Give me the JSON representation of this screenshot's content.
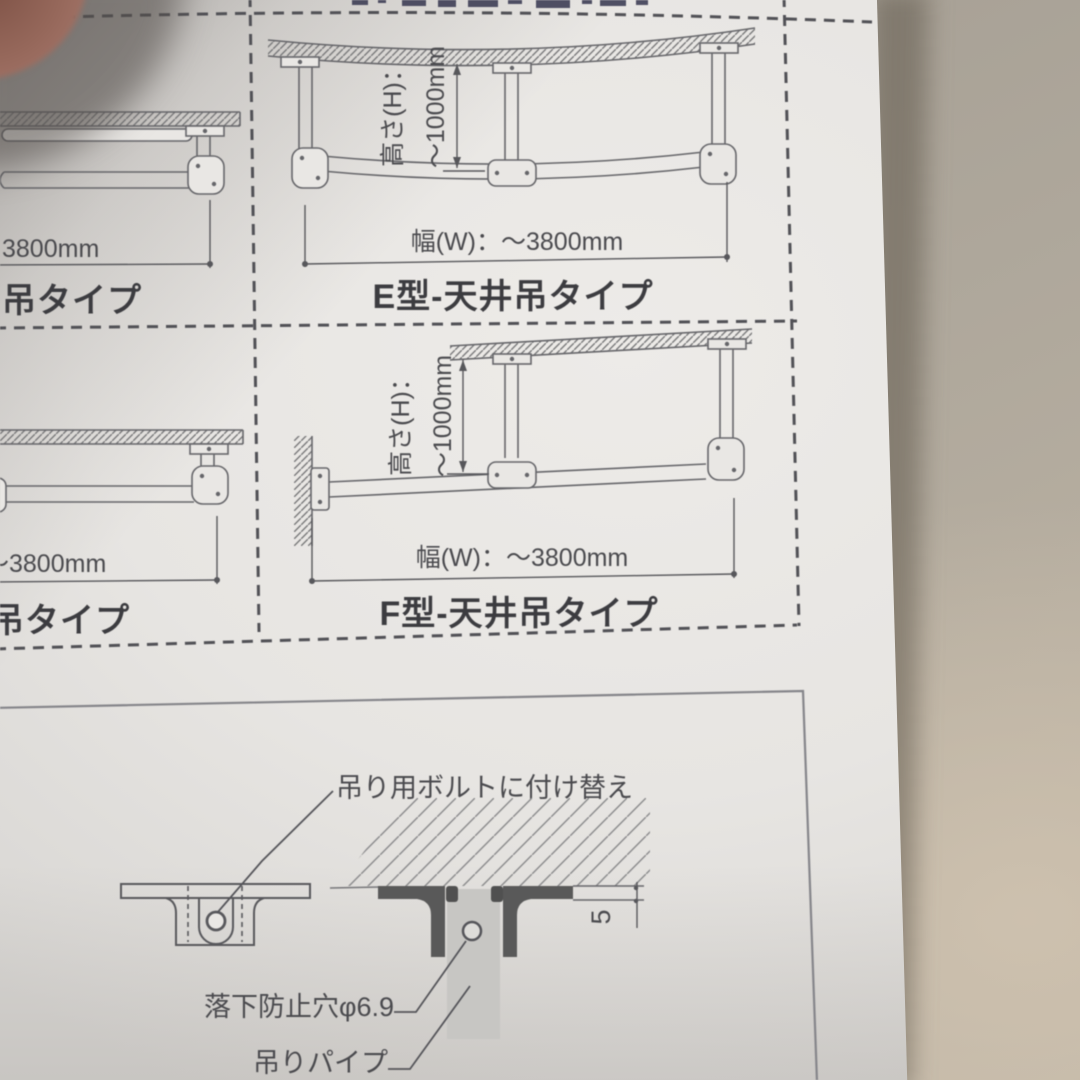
{
  "document": {
    "description_note": "photographed instruction sheet of pipe hanger rack types",
    "panels": [
      {
        "id": "top-left-partial",
        "title": "吊タイプ",
        "width_label": "3800mm"
      },
      {
        "id": "e-type",
        "title": "E型-天井吊タイプ",
        "height_label": "高さ(H)：",
        "height_value": "～1000mm",
        "width_label": "幅(W)：～3800mm"
      },
      {
        "id": "bottom-left-partial",
        "title": "吊タイプ",
        "width_label": "～3800mm"
      },
      {
        "id": "f-type",
        "title": "F型-天井吊タイプ",
        "height_label": "高さ(H)：",
        "height_value": "～1000mm",
        "width_label": "幅(W)：～3800mm"
      }
    ],
    "detail": {
      "replace_bolt_label": "吊り用ボルトに付け替え",
      "fall_prevention_hole_label": "落下防止穴φ6.9",
      "hanging_pipe_label": "吊りパイプ",
      "plate_thickness_mm": "5"
    },
    "colors": {
      "paper": "#e9e7e4",
      "background": "#b0a89c",
      "line": "#66666a",
      "dark_fill": "#595959",
      "pipe_gray": "#c7c6c3",
      "finger": "#96685b"
    }
  }
}
